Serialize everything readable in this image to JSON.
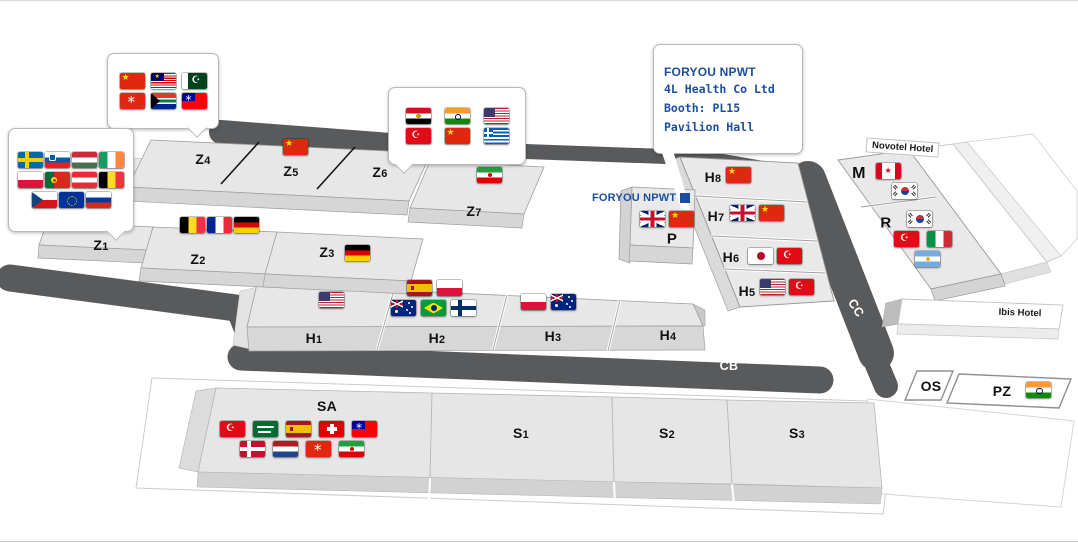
{
  "colors": {
    "brand_blue": "#1c4ea0",
    "corridor_gray": "#595a5c"
  },
  "callouts": {
    "asia": {
      "flag_rows": [
        [
          "china",
          "malaysia",
          "pakistan"
        ],
        [
          "hong-kong",
          "south-africa",
          "taiwan"
        ]
      ]
    },
    "europe": {
      "flag_rows": [
        [
          "sweden",
          "slovenia",
          "hungary",
          "ireland"
        ],
        [
          "poland",
          "portugal",
          "austria",
          "belgium"
        ],
        [
          "czech-republic",
          "eu",
          "russia"
        ]
      ]
    },
    "middle_east": {
      "flag_rows": [
        [
          "egypt",
          "india",
          "usa"
        ],
        [
          "turkey",
          "china",
          "greece"
        ]
      ]
    },
    "exhibitor": {
      "logo": "FORYOU NPWT",
      "company": "4L Health Co Ltd",
      "booth": "Booth: PL15",
      "hall": "Pavilion Hall"
    }
  },
  "map_marker": {
    "logo": "FORYOU NPWT"
  },
  "blocks": {
    "z1": {
      "label": "Z1"
    },
    "z2": {
      "label": "Z2",
      "flag_rows": [
        [
          "belgium",
          "france",
          "germany"
        ]
      ]
    },
    "z3": {
      "label": "Z3",
      "flag_rows": [
        [
          "germany"
        ]
      ]
    },
    "z4": {
      "label": "Z4"
    },
    "z5": {
      "label": "Z5",
      "flag_rows": [
        [
          "china"
        ]
      ]
    },
    "z6": {
      "label": "Z6"
    },
    "z7": {
      "label": "Z7",
      "flag_rows": [
        [
          "iran"
        ]
      ]
    },
    "h1": {
      "label": "H1",
      "flag_rows": [
        [
          "usa"
        ]
      ]
    },
    "h2": {
      "label": "H2",
      "flag_rows": [
        [
          "spain",
          "poland"
        ],
        [
          "australia",
          "brazil",
          "finland"
        ]
      ]
    },
    "h3": {
      "label": "H3",
      "flag_rows": [
        [
          "poland",
          "australia"
        ]
      ]
    },
    "h4": {
      "label": "H4"
    },
    "h5": {
      "label": "H5",
      "flag_rows": [
        [
          "usa",
          "turkey"
        ]
      ]
    },
    "h6": {
      "label": "H6",
      "flag_rows": [
        [
          "japan",
          "turkey"
        ]
      ]
    },
    "h7": {
      "label": "H7",
      "flag_rows": [
        [
          "uk",
          "china"
        ]
      ]
    },
    "h8": {
      "label": "H8",
      "flag_rows": [
        [
          "china"
        ]
      ]
    },
    "p": {
      "label": "P",
      "flag_rows": [
        [
          "uk",
          "china"
        ]
      ]
    },
    "m": {
      "label": "M",
      "flag_rows": [
        [
          "canada"
        ],
        [
          "south-korea"
        ]
      ]
    },
    "r": {
      "label": "R",
      "flag_rows": [
        [
          "south-korea"
        ],
        [
          "turkey",
          "italy"
        ],
        [
          "argentina"
        ]
      ]
    },
    "sa": {
      "label": "SA",
      "flag_rows": [
        [
          "turkey",
          "saudi-arabia",
          "spain",
          "switzerland",
          "taiwan"
        ],
        [
          "denmark",
          "netherlands",
          "hong-kong",
          "iran"
        ]
      ]
    },
    "s1": {
      "label": "S1"
    },
    "s2": {
      "label": "S2"
    },
    "s3": {
      "label": "S3"
    },
    "cb": {
      "label": "CB"
    },
    "cc": {
      "label": "CC"
    },
    "os": {
      "label": "OS"
    },
    "pz": {
      "label": "PZ",
      "flag_rows": [
        [
          "india"
        ]
      ]
    },
    "novotel": {
      "label": "Novotel Hotel"
    },
    "ibis": {
      "label": "Ibis Hotel"
    }
  }
}
